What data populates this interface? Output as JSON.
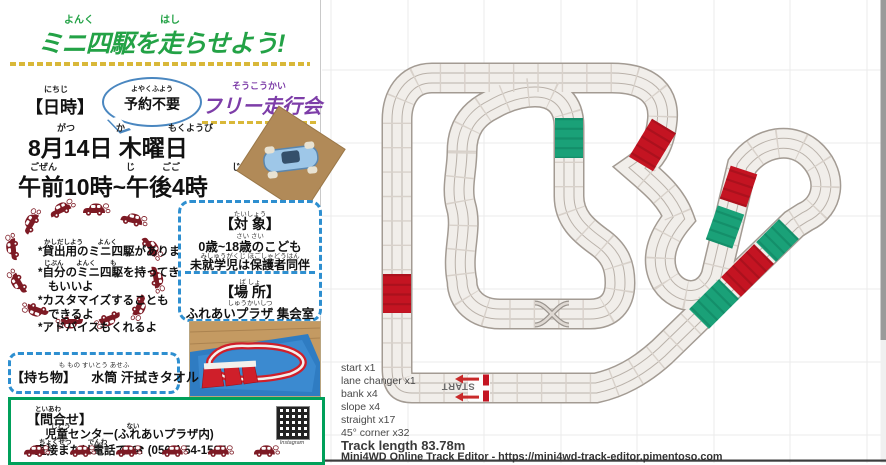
{
  "flyer": {
    "title": {
      "ruby_left": "よんく",
      "ruby_right": "はし",
      "text": "ミニ四駆を走らせよう!"
    },
    "header": {
      "datetime_ruby": "にちじ",
      "datetime_label": "【日時】",
      "bubble_ruby": "よやくふよう",
      "bubble_text": "予約不要",
      "event_ruby": "そうこうかい",
      "event_name": "フリー走行会"
    },
    "schedule": {
      "date_ruby_1": "がつ",
      "date_ruby_2": "か",
      "date_ruby_3": "もくようび",
      "date_text": "8月14日 木曜日",
      "time_ruby_1": "ごぜん",
      "time_ruby_2": "じ",
      "time_ruby_3": "ごご",
      "time_ruby_4": "じ",
      "time_text": "午前10時~午後4時"
    },
    "notes": [
      {
        "ruby": "かしだしよう        よんく",
        "text": "*貸出用のミニ四駆があります"
      },
      {
        "ruby": "じぶん       よんく        も",
        "text": "*自分のミニ四駆を持ってきて"
      },
      {
        "ruby": "",
        "text": "もいいよ"
      },
      {
        "ruby": "",
        "text": "*カスタマイズすることも"
      },
      {
        "ruby": "",
        "text": "できるよ"
      },
      {
        "ruby": "",
        "text": "*アドバイスもくれるよ"
      }
    ],
    "target_box": {
      "label_ruby": "たいしょう",
      "label": "【対 象】",
      "line1_ruby": "さい         さい",
      "line1": "0歳~18歳のこども",
      "line2_ruby": "みしゅうがくじ    ほごしゃどうはん",
      "line2": "未就学児は保護者同伴",
      "place_ruby": "ば    しょ",
      "place_label": "【場 所】",
      "place_line_ruby": "しゅうかいしつ",
      "place_line": "ふれあいプラザ 集会室"
    },
    "items_box": {
      "ruby": "も  もの        すいとう     あせふ",
      "label": "【持ち物】",
      "text": "水筒 汗拭きタオル"
    },
    "contact_box": {
      "label_ruby": "といあわ",
      "label": "【問合せ】",
      "line1_ruby": "じどう                               ない",
      "line1": "児童センター(ふれあいプラザ内)",
      "line2_ruby": "ちょくせつ         でんわ",
      "line2": "直接または電話で ☎ (0562) 54-1535",
      "qr_label": "Instagram"
    }
  },
  "track_editor": {
    "stats": [
      "start x1",
      "lane changer x1",
      "bank x4",
      "slope x4",
      "straight x17",
      "45° corner x32"
    ],
    "stats_joined": "start x1\nlane changer x1\nbank x4\nslope x4\nstraight x17\n45° corner x32",
    "track_length": "Track length 83.78m",
    "credit": "Mini4WD Online Track Editor - https://mini4wd-track-editor.pimentoso.com",
    "start_label": "START",
    "colors": {
      "track": "#f1eeea",
      "bank_green": "#1aa178",
      "slope_red": "#c41422",
      "grid": "#ebebeb"
    }
  }
}
